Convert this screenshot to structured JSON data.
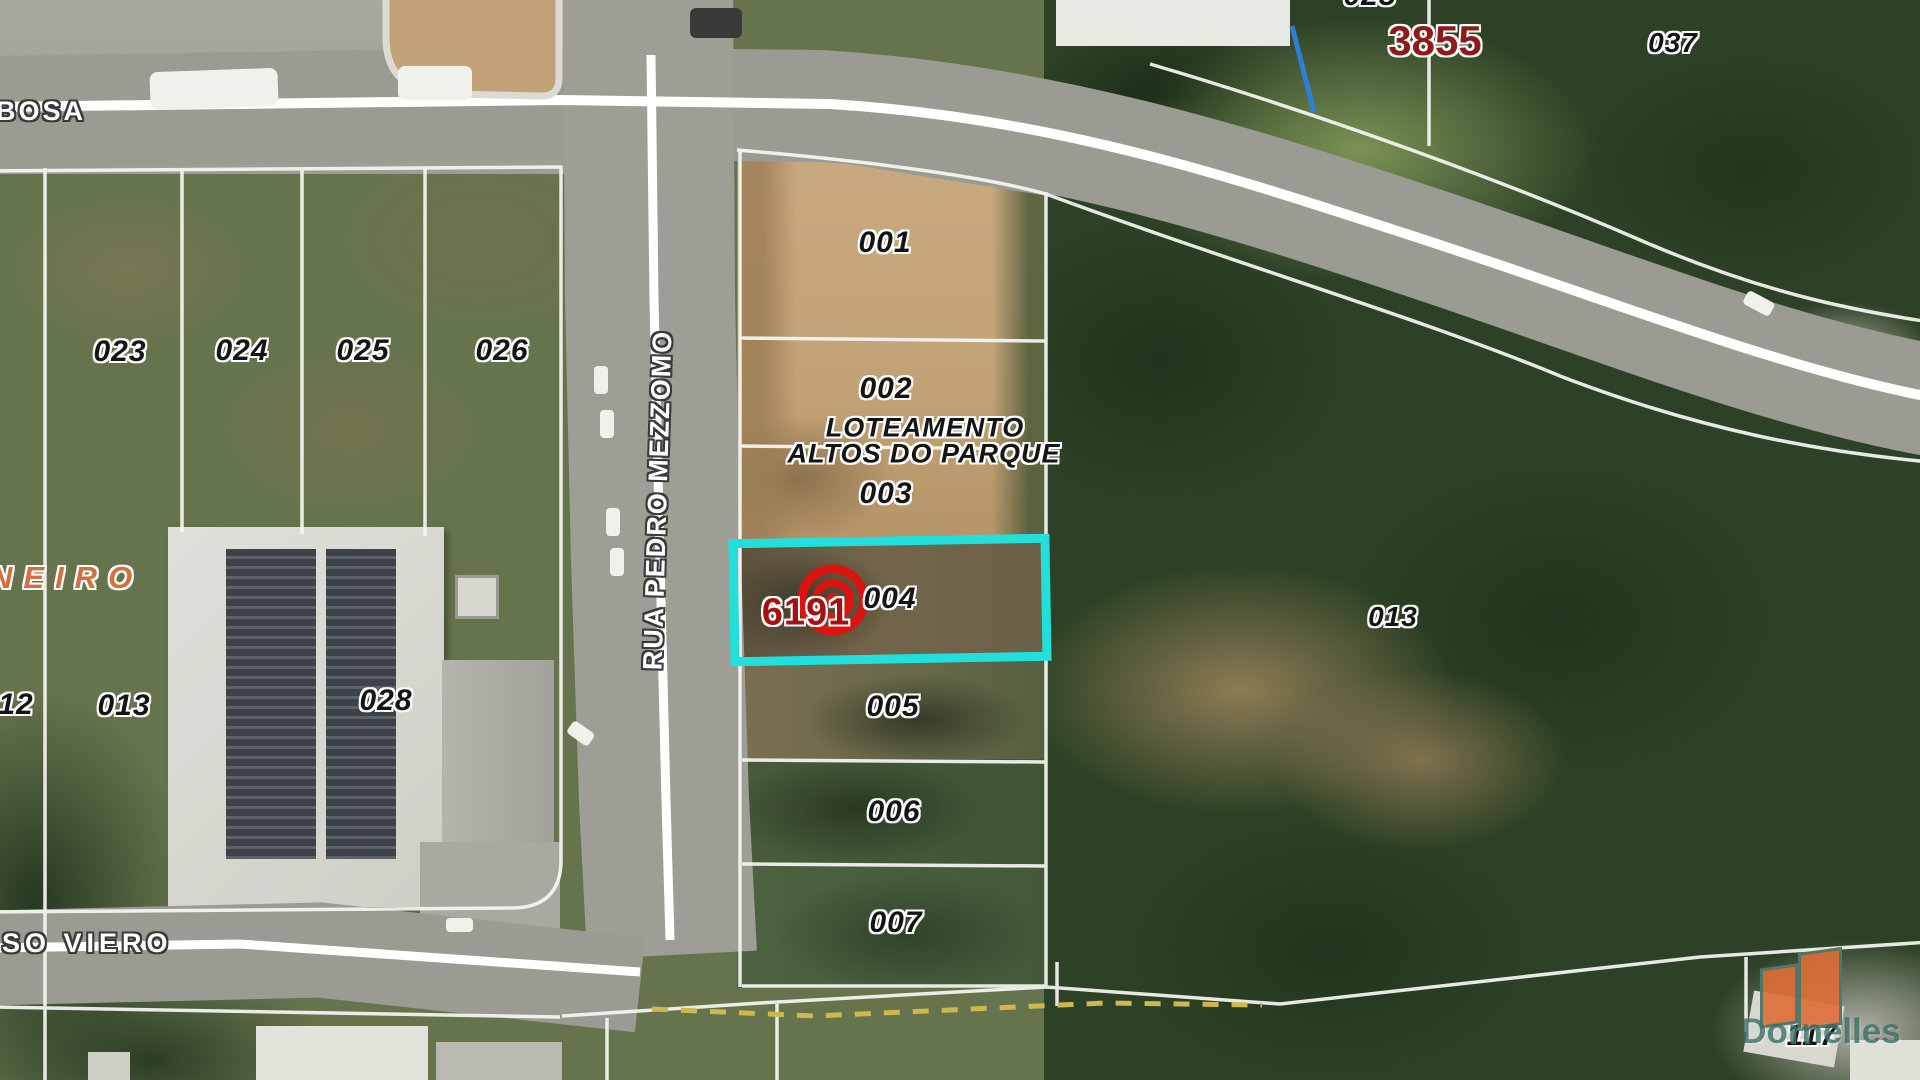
{
  "streets": {
    "top_partial": "BOSA",
    "vertical": "RUA PEDRO MEZZOMO",
    "bottom_partial": "SO VIERO"
  },
  "district_partial": "NEIRO",
  "development": {
    "line1": "LOTEAMENTO",
    "line2": "ALTOS DO PARQUE"
  },
  "highlight": {
    "code": "6191",
    "lot_id": "004",
    "outline_color": "#22dfdb",
    "marker_color": "#dc1410",
    "code_color": "#a31113"
  },
  "ref_label": {
    "code": "3855",
    "color": "#8e1a1e"
  },
  "lots": {
    "column": [
      "001",
      "002",
      "003",
      "005",
      "006",
      "007"
    ],
    "left_row": [
      "023",
      "024",
      "025",
      "026"
    ],
    "left_lower": [
      "12",
      "013",
      "028"
    ],
    "right": "013",
    "far_right": "037",
    "top_partial": "025",
    "bottom_right": "117"
  },
  "watermark": {
    "brand": "Dornelles"
  }
}
